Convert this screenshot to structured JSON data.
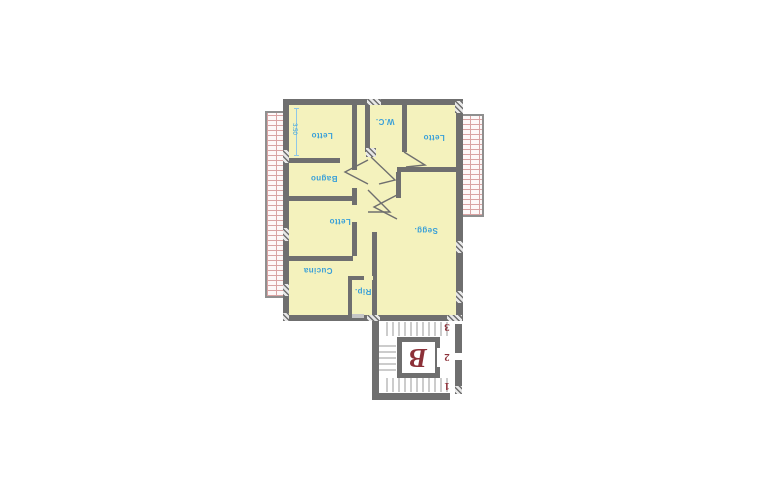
{
  "plan": {
    "title": "apartment-floor-plan",
    "dimension_label": "3.50",
    "rooms": [
      {
        "id": "letto-top-left",
        "label": "Letto"
      },
      {
        "id": "wc",
        "label": "W.C."
      },
      {
        "id": "letto-top-right",
        "label": "Letto"
      },
      {
        "id": "bagno",
        "label": "Bagno"
      },
      {
        "id": "letto-middle",
        "label": "Letto"
      },
      {
        "id": "cucina",
        "label": "Cucina"
      },
      {
        "id": "ripostiglio",
        "label": "Rip."
      },
      {
        "id": "soggiorno",
        "label": "Segg."
      }
    ],
    "stairwell": {
      "unit_letter": "B",
      "floor_numbers": [
        {
          "label": "3"
        },
        {
          "label": "2"
        },
        {
          "label": "1"
        }
      ]
    },
    "colors": {
      "room_fill": "#f4f2bd",
      "wall": "#6f6f6f",
      "room_text": "#3aa0d8",
      "brick_line": "#d9a3a3",
      "stair_letter": "#8c3038"
    }
  }
}
